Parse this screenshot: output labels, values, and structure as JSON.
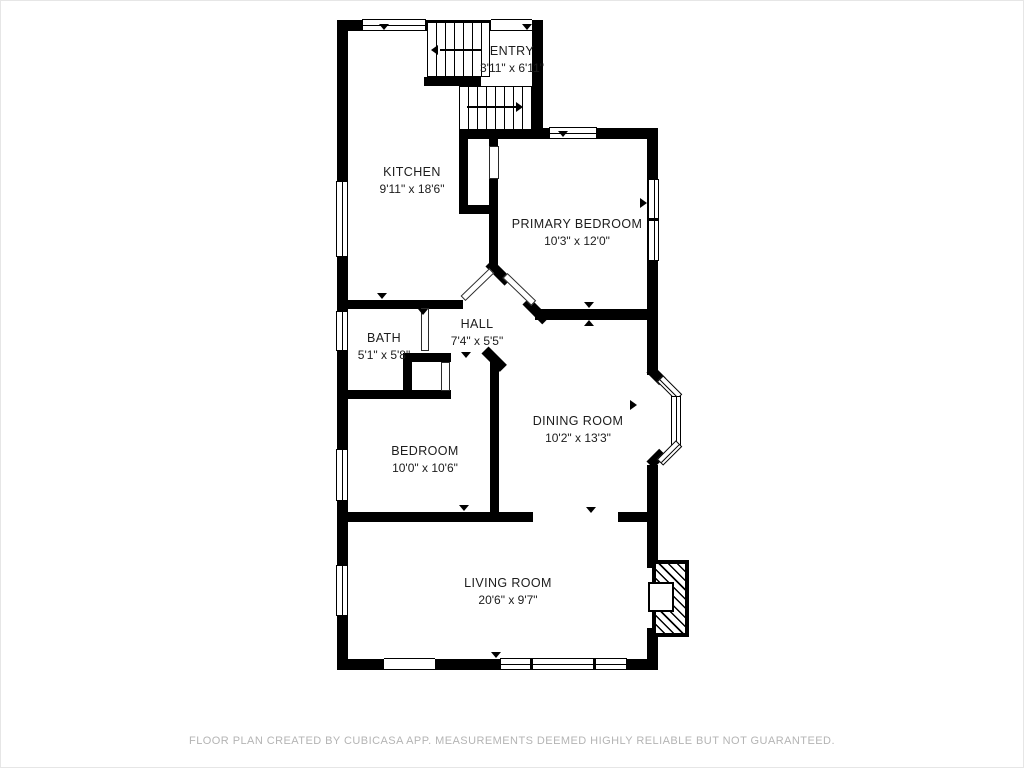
{
  "meta": {
    "footer": "FLOOR PLAN CREATED BY CUBICASA APP. MEASUREMENTS DEEMED HIGHLY RELIABLE BUT NOT GUARANTEED."
  },
  "colors": {
    "wall": "#000000",
    "background": "#ffffff",
    "footer_text": "#b4b4b4"
  },
  "rooms": [
    {
      "name": "ENTRY",
      "dims": "3'11\" x 6'11\""
    },
    {
      "name": "KITCHEN",
      "dims": "9'11\" x 18'6\""
    },
    {
      "name": "PRIMARY BEDROOM",
      "dims": "10'3\" x 12'0\""
    },
    {
      "name": "HALL",
      "dims": "7'4\" x 5'5\""
    },
    {
      "name": "BATH",
      "dims": "5'1\" x 5'8\""
    },
    {
      "name": "BEDROOM",
      "dims": "10'0\" x 10'6\""
    },
    {
      "name": "DINING ROOM",
      "dims": "10'2\" x 13'3\""
    },
    {
      "name": "LIVING ROOM",
      "dims": "20'6\" x 9'7\""
    }
  ]
}
